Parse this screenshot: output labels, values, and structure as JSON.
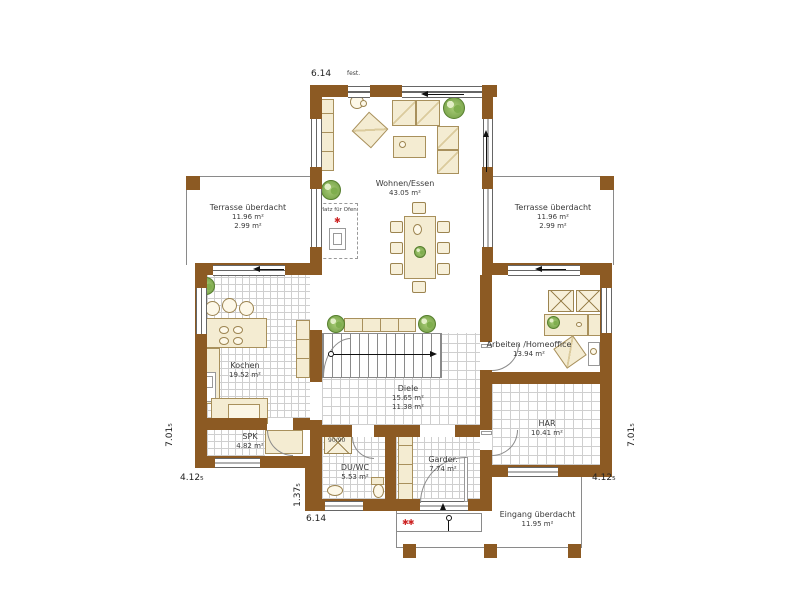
{
  "rooms": {
    "wohnen_essen": {
      "name": "Wohnen/Essen",
      "area": "43.05 m²"
    },
    "terrasse_links": {
      "name": "Terrasse überdacht",
      "area": "11.96 m²",
      "area2": "2.99 m²"
    },
    "terrasse_rechts": {
      "name": "Terrasse überdacht",
      "area": "11.96 m²",
      "area2": "2.99 m²"
    },
    "kochen": {
      "name": "Kochen",
      "area": "19.52 m²"
    },
    "spk": {
      "name": "SPK",
      "area": "4.82 m²"
    },
    "diele": {
      "name": "Diele",
      "area": "15.65 m²",
      "area2": "11.38 m²"
    },
    "du_wc": {
      "name": "DU/WC",
      "area": "5.53 m²"
    },
    "garderobe": {
      "name": "Garder.",
      "area": "7.74 m²"
    },
    "arbeiten": {
      "name": "Arbeiten /Homeoffice",
      "area": "13.94 m²"
    },
    "har": {
      "name": "HAR",
      "area": "10.41 m²"
    },
    "eingang": {
      "name": "Eingang überdacht",
      "area": "11.95 m²"
    }
  },
  "dimensions": {
    "top_width": "6.14",
    "bottom_width": "6.14",
    "left_height": "7.01₅",
    "right_height": "7.01₅",
    "left_terrace_depth": "4.12₅",
    "right_terrace_depth": "4.12₅",
    "notch_depth": "1.37₅"
  },
  "annotations": {
    "fixed_glazing": "fest.",
    "oven_note": "Platz für Ofen",
    "shower_size": "90/90",
    "marker_single": "✱",
    "marker_double": "✱✱"
  },
  "colors": {
    "wall": "#8c5a23",
    "furniture": "#f4ecd2",
    "plant_green": "#8fbf5a",
    "marker_red": "#cc2222",
    "tile_line": "#cfcfcf"
  }
}
